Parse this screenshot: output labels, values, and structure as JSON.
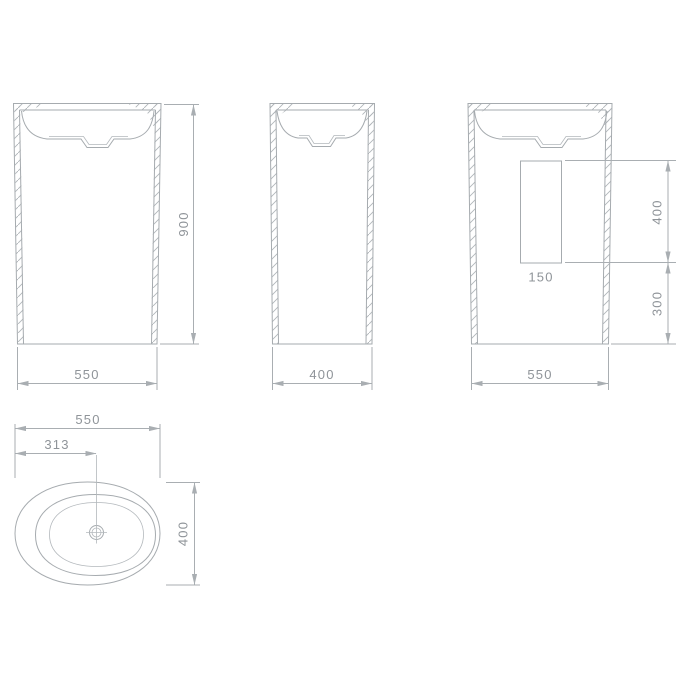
{
  "drawing": {
    "front_view": {
      "width_label": "550",
      "height_label": "900"
    },
    "side_view": {
      "width_label": "400"
    },
    "back_view": {
      "width_label": "550",
      "cutout_width_label": "150",
      "cutout_height_label": "400",
      "cutout_bottom_offset_label": "300"
    },
    "plan_view": {
      "width_label": "550",
      "drain_offset_label": "313",
      "depth_label": "400"
    },
    "colors": {
      "line": "#a6abaf",
      "text": "#8f9499",
      "background": "#ffffff"
    }
  }
}
